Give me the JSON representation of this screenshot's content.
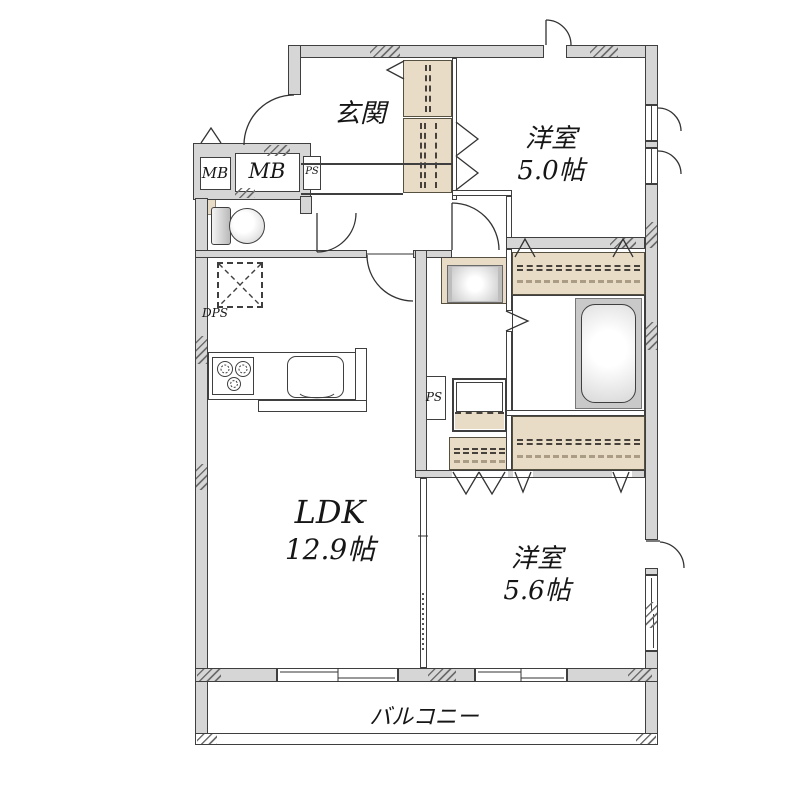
{
  "rooms": {
    "genkan": {
      "label": "玄関"
    },
    "bedroom_top": {
      "name": "洋室",
      "size": "5.0帖"
    },
    "ldk": {
      "name": "LDK",
      "size": "12.9帖"
    },
    "bedroom_bottom": {
      "name": "洋室",
      "size": "5.6帖"
    },
    "balcony": {
      "label": "バルコニー"
    }
  },
  "utility_labels": {
    "meter_box_small": "MB",
    "meter_box_large": "MB",
    "pipe_space_top": "PS",
    "pipe_space_middle": "PS",
    "drain_pipe_space": "DPS"
  },
  "colors": {
    "wall_fill": "#d6d6d6",
    "wall_line": "#3f3f3f",
    "closet_fill": "#e9dcc6",
    "tub_surround": "#c9c9c9",
    "background": "#ffffff"
  }
}
